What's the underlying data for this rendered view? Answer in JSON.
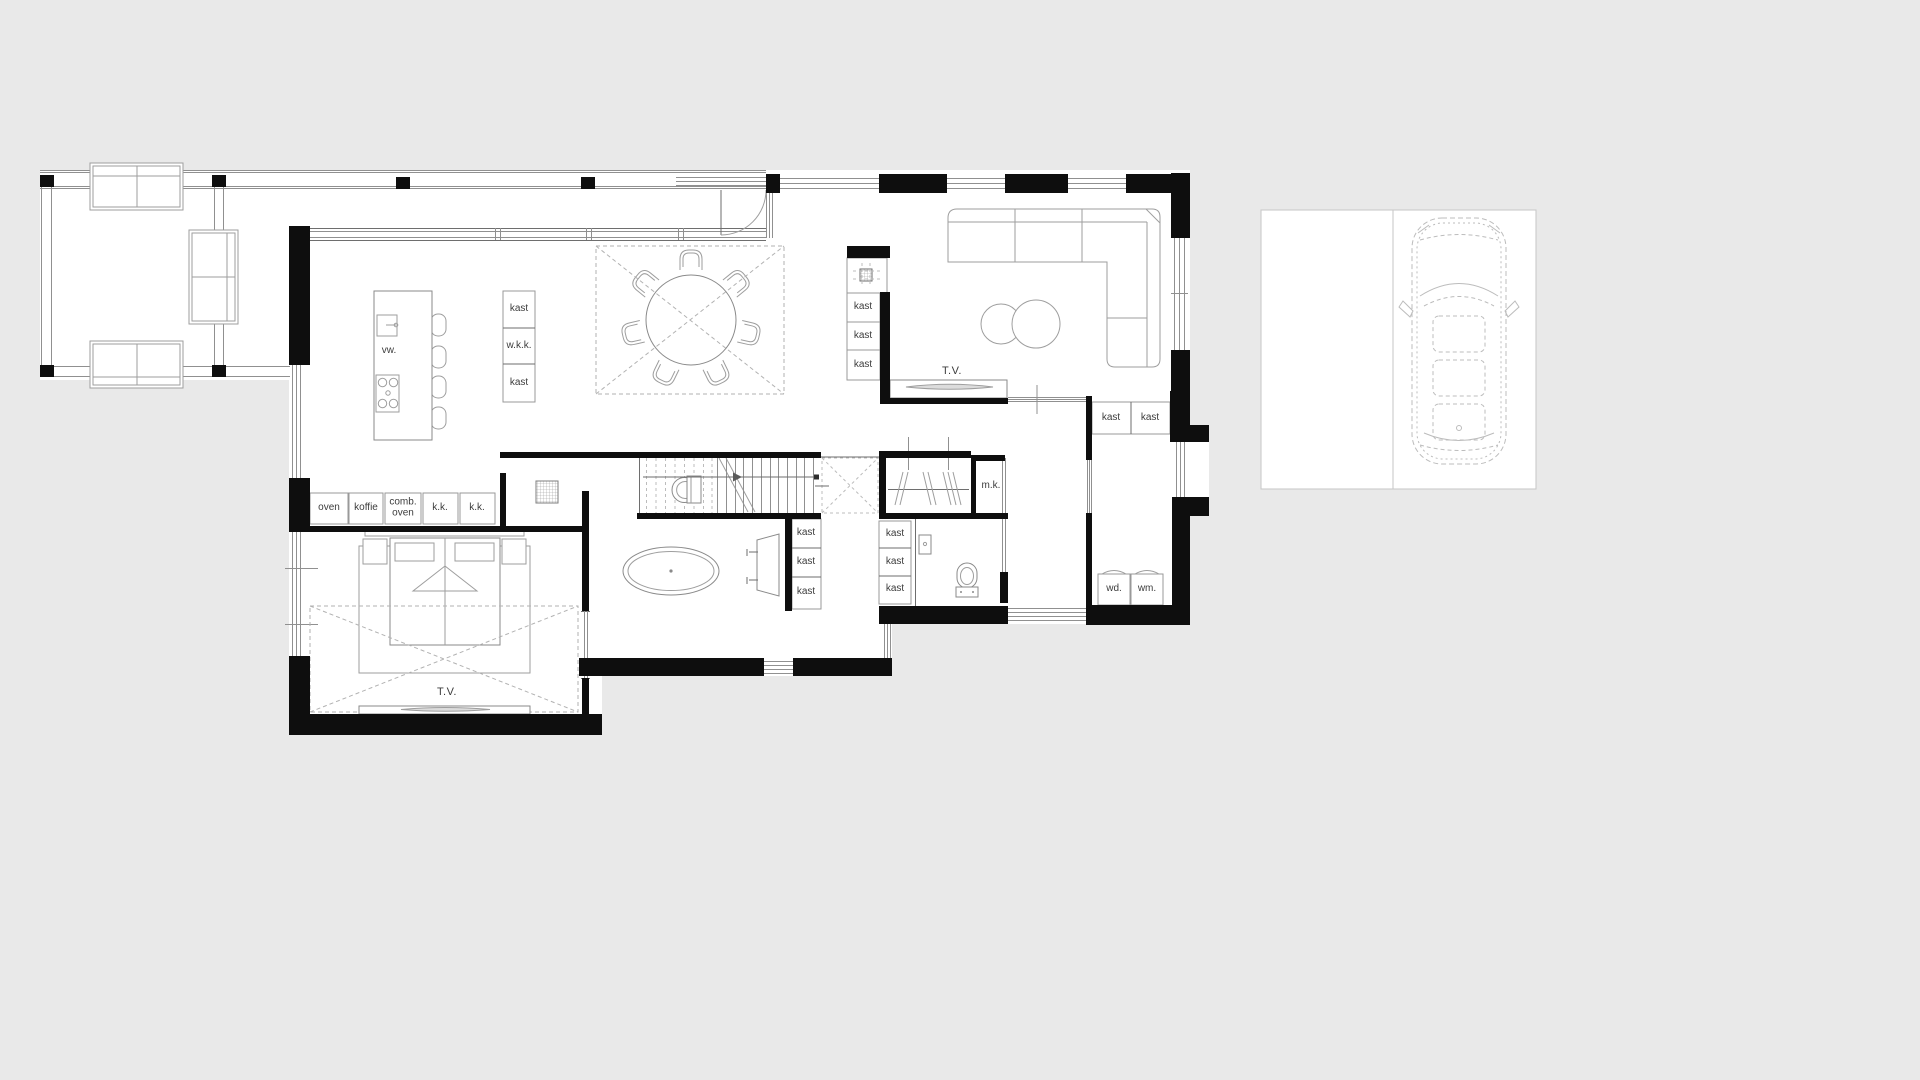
{
  "colors": {
    "background": "#e9e9e9",
    "plan_white": "#ffffff",
    "wall": "#0e0e0e",
    "furniture": "#9e9e9e",
    "label": "#3c3c3c"
  },
  "labels": {
    "kitchen": {
      "dishwasher": "vw.",
      "cabinets": [
        "kast",
        "w.k.k.",
        "kast"
      ],
      "appliances": [
        "oven",
        "koffie",
        "comb. oven",
        "k.k.",
        "k.k."
      ]
    },
    "living": {
      "tv": "T.V.",
      "fireplace_cabinets": [
        "kast",
        "kast",
        "kast"
      ]
    },
    "hall": {
      "closets": [
        "kast",
        "kast"
      ],
      "meter_closet": "m.k."
    },
    "bathroom": {
      "closets": [
        "kast",
        "kast",
        "kast"
      ]
    },
    "wc": {
      "closets": [
        "kast",
        "kast",
        "kast"
      ]
    },
    "utility": {
      "appliances": [
        "wd.",
        "wm."
      ]
    },
    "bedroom": {
      "tv": "T.V."
    }
  }
}
